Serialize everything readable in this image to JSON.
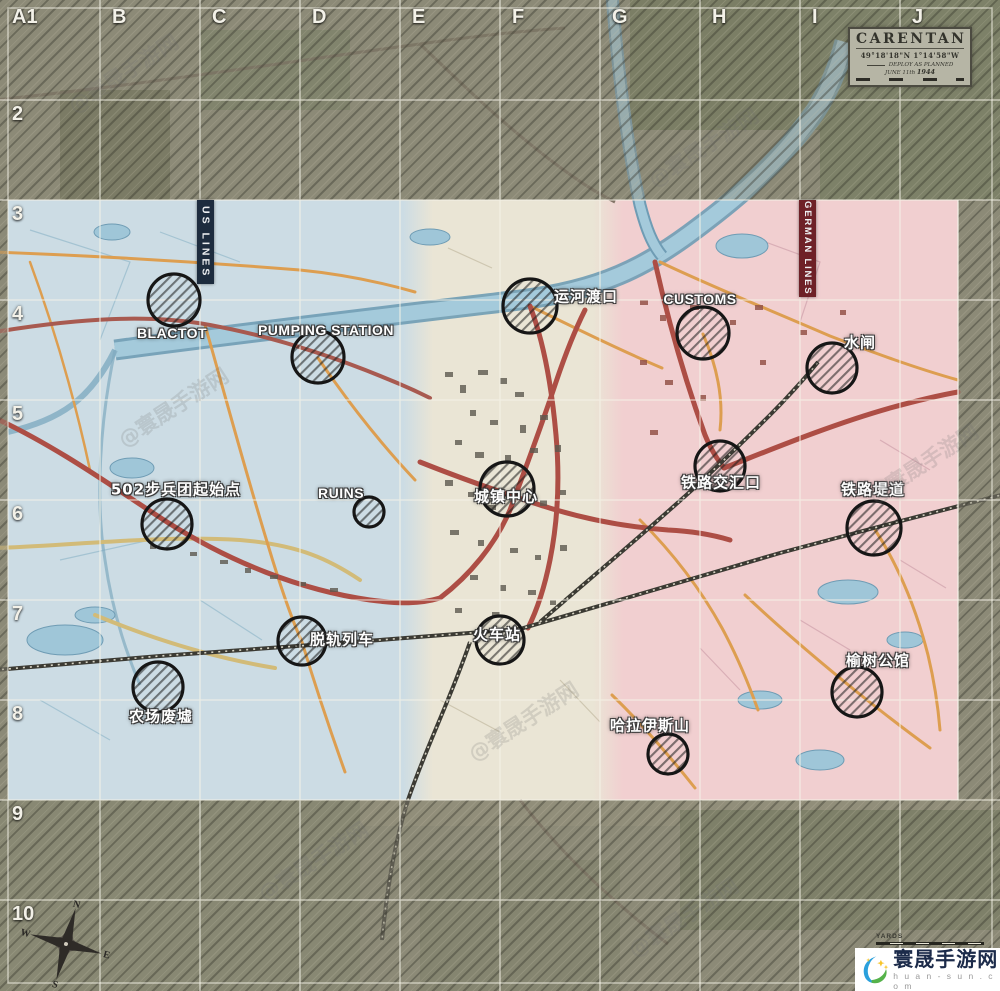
{
  "map": {
    "title_box": {
      "title": "CARENTAN",
      "coordinates": "49°18'18\"N  1°14'58\"W",
      "deploy_note": "DEPLOY AS PLANNED",
      "date_prefix": "JUNE 11th",
      "date_year": "1944"
    },
    "banners": {
      "us": "US LINES",
      "german": "GERMAN LINES"
    },
    "grid": {
      "columns": [
        "A1",
        "B",
        "C",
        "D",
        "E",
        "F",
        "G",
        "H",
        "I",
        "J"
      ],
      "rows": [
        "2",
        "3",
        "4",
        "5",
        "6",
        "7",
        "8",
        "9",
        "10"
      ]
    },
    "compass": {
      "n": "N",
      "e": "E",
      "s": "S",
      "w": "W"
    },
    "scale_label": "YARDS",
    "zones": {
      "us_color": "#ccdce4",
      "center_color": "#eae5d5",
      "german_color": "#f1cfd0",
      "us_banner_color": "#1d2c3e",
      "german_banner_color": "#6e2127"
    },
    "pois": [
      {
        "id": "blactot",
        "label": "BLACTOT",
        "lang": "en",
        "cx": 174,
        "cy": 300,
        "r": 26,
        "lx": 172,
        "ly": 333
      },
      {
        "id": "pumping-station",
        "label": "PUMPING STATION",
        "lang": "en",
        "cx": 318,
        "cy": 357,
        "r": 26,
        "lx": 326,
        "ly": 330
      },
      {
        "id": "canal-crossing",
        "label": "运河渡口",
        "lang": "zh",
        "cx": 530,
        "cy": 306,
        "r": 27,
        "lx": 586,
        "ly": 297
      },
      {
        "id": "customs",
        "label": "CUSTOMS",
        "lang": "en",
        "cx": 703,
        "cy": 333,
        "r": 26,
        "lx": 700,
        "ly": 299
      },
      {
        "id": "sluice-gate",
        "label": "水闸",
        "lang": "zh",
        "cx": 832,
        "cy": 368,
        "r": 25,
        "lx": 860,
        "ly": 343
      },
      {
        "id": "502-start",
        "label": "502步兵团起始点",
        "lang": "zh",
        "cx": 167,
        "cy": 524,
        "r": 25,
        "lx": 176,
        "ly": 490
      },
      {
        "id": "ruins",
        "label": "RUINS",
        "lang": "en",
        "cx": 369,
        "cy": 512,
        "r": 15,
        "lx": 341,
        "ly": 493
      },
      {
        "id": "town-center",
        "label": "城镇中心",
        "lang": "zh",
        "cx": 507,
        "cy": 489,
        "r": 27,
        "lx": 506,
        "ly": 497
      },
      {
        "id": "rail-junction",
        "label": "铁路交汇口",
        "lang": "zh",
        "cx": 720,
        "cy": 466,
        "r": 25,
        "lx": 721,
        "ly": 483
      },
      {
        "id": "rail-causeway",
        "label": "铁路堤道",
        "lang": "zh",
        "cx": 874,
        "cy": 528,
        "r": 27,
        "lx": 873,
        "ly": 490
      },
      {
        "id": "derailed-train",
        "label": "脱轨列车",
        "lang": "zh",
        "cx": 302,
        "cy": 641,
        "r": 24,
        "lx": 342,
        "ly": 640
      },
      {
        "id": "train-station",
        "label": "火车站",
        "lang": "zh",
        "cx": 500,
        "cy": 640,
        "r": 24,
        "lx": 497,
        "ly": 635
      },
      {
        "id": "elm-mansion",
        "label": "榆树公馆",
        "lang": "zh",
        "cx": 857,
        "cy": 692,
        "r": 25,
        "lx": 878,
        "ly": 661
      },
      {
        "id": "farm-ruins",
        "label": "农场废墟",
        "lang": "zh",
        "cx": 158,
        "cy": 687,
        "r": 25,
        "lx": 161,
        "ly": 717
      },
      {
        "id": "mount-halais",
        "label": "哈拉伊斯山",
        "lang": "zh",
        "cx": 668,
        "cy": 754,
        "r": 20,
        "lx": 650,
        "ly": 726
      }
    ],
    "diagonal_watermark": "@寰晟手游网",
    "watermark_positions": [
      [
        60,
        58
      ],
      [
        640,
        132
      ],
      [
        110,
        392
      ],
      [
        860,
        448
      ],
      [
        460,
        706
      ],
      [
        620,
        902
      ],
      [
        250,
        846
      ]
    ],
    "watermark_badge": {
      "site_name": "寰晟手游网",
      "site_url": "h u a n - s u n . c o m"
    }
  }
}
